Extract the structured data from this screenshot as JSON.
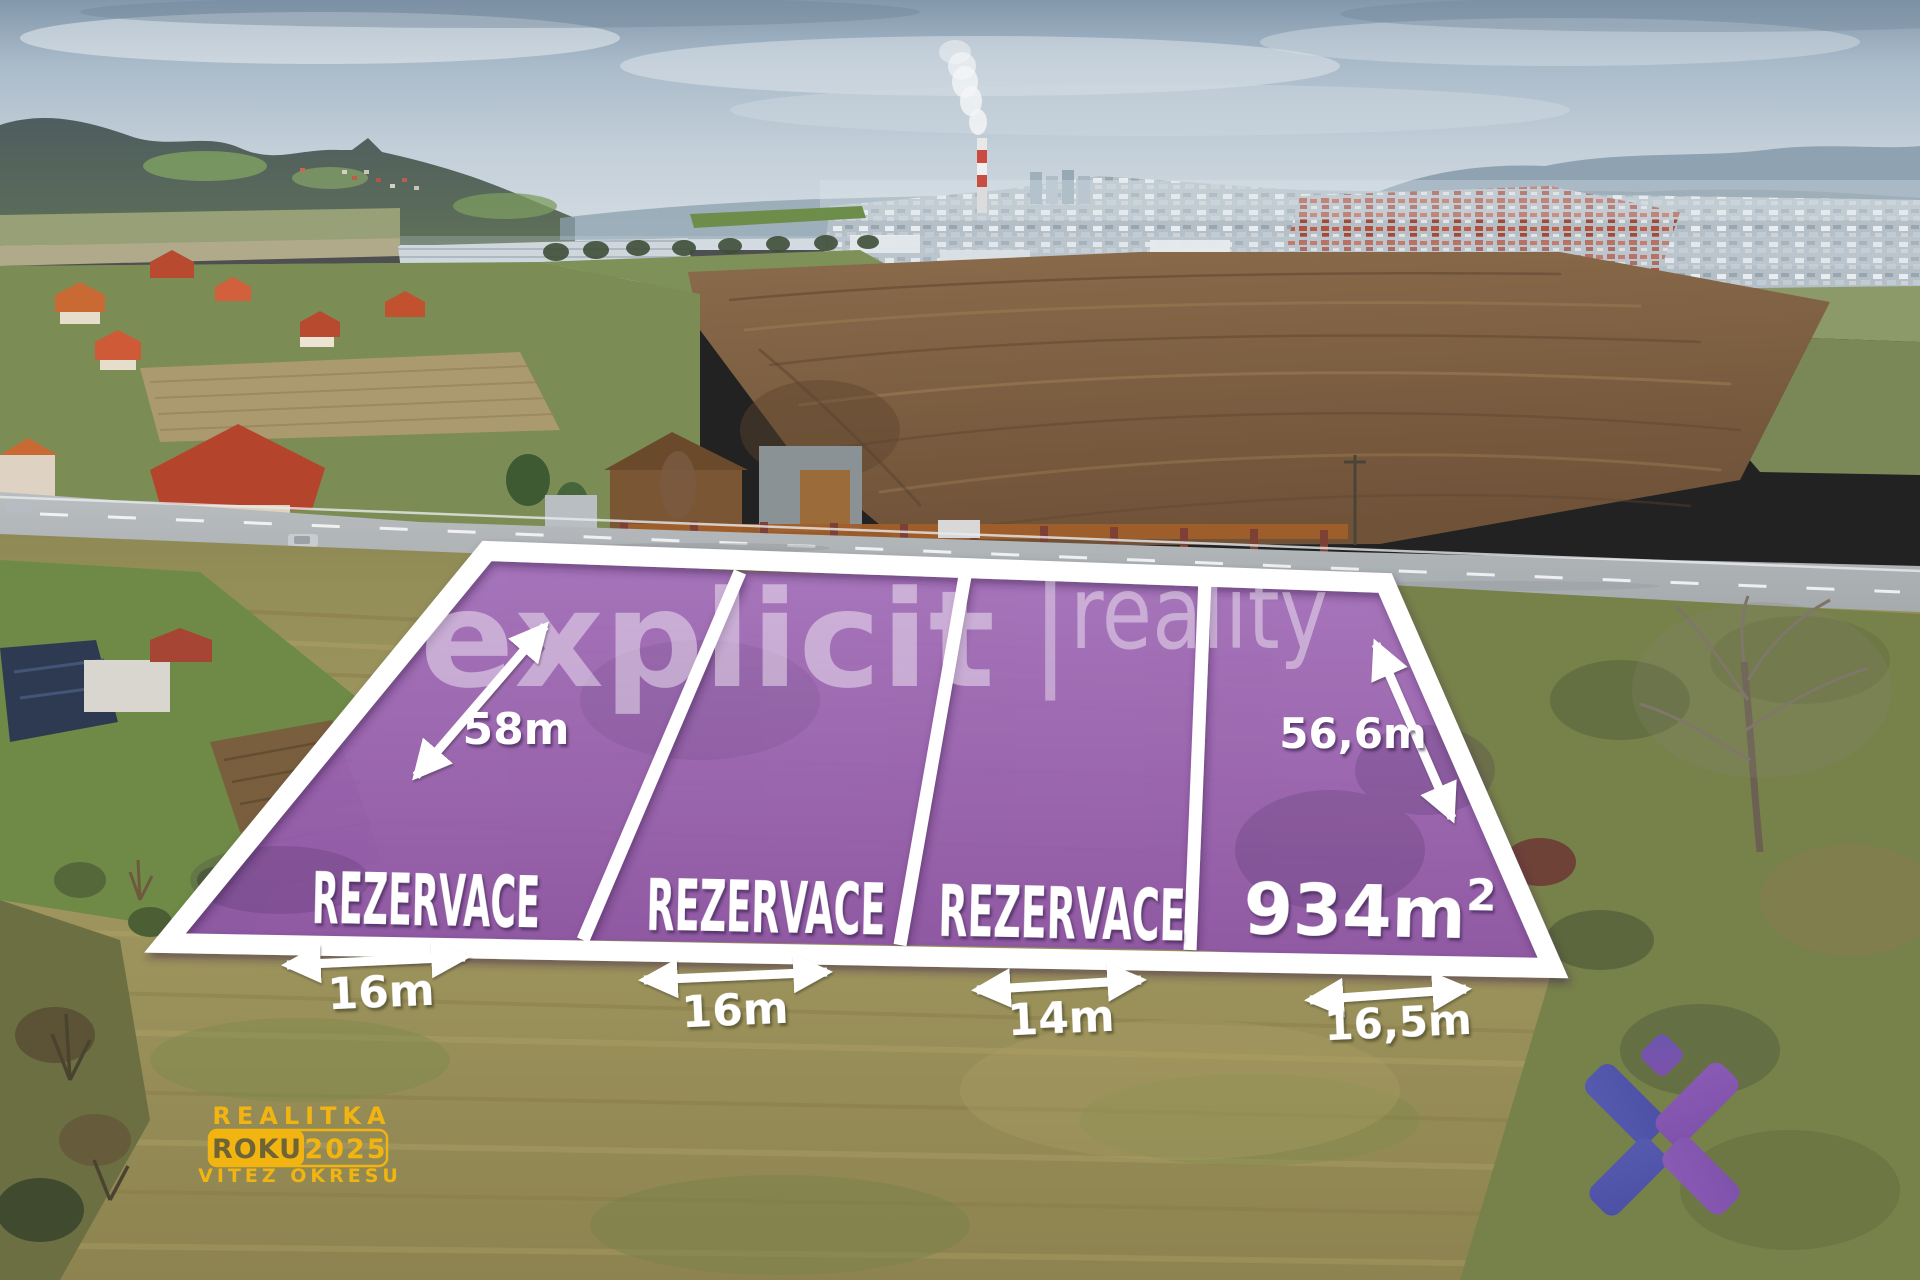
{
  "watermark": {
    "primary": "explicit",
    "divider": "|",
    "secondary": "reality"
  },
  "plots": {
    "fill_color": "#9A62B4",
    "border_color": "#FFFFFF",
    "items": [
      {
        "id": "plot-1",
        "status": "REZERVACE",
        "width_label": "16m",
        "depth_label": "58m"
      },
      {
        "id": "plot-2",
        "status": "REZERVACE",
        "width_label": "16m"
      },
      {
        "id": "plot-3",
        "status": "REZERVACE",
        "width_label": "14m"
      },
      {
        "id": "plot-4",
        "area_label": "934m",
        "area_superscript": "2",
        "width_label": "16,5m",
        "depth_label": "56,6m"
      }
    ]
  },
  "award_badge": {
    "line1": "REALITKA",
    "box_word": "ROKU",
    "year": "2025",
    "line2": "VÍTĚZ OKRESU",
    "color": "#F2B411"
  },
  "brand_mark": {
    "color_blue": "#4B50A5",
    "color_purple": "#7E51AB"
  }
}
